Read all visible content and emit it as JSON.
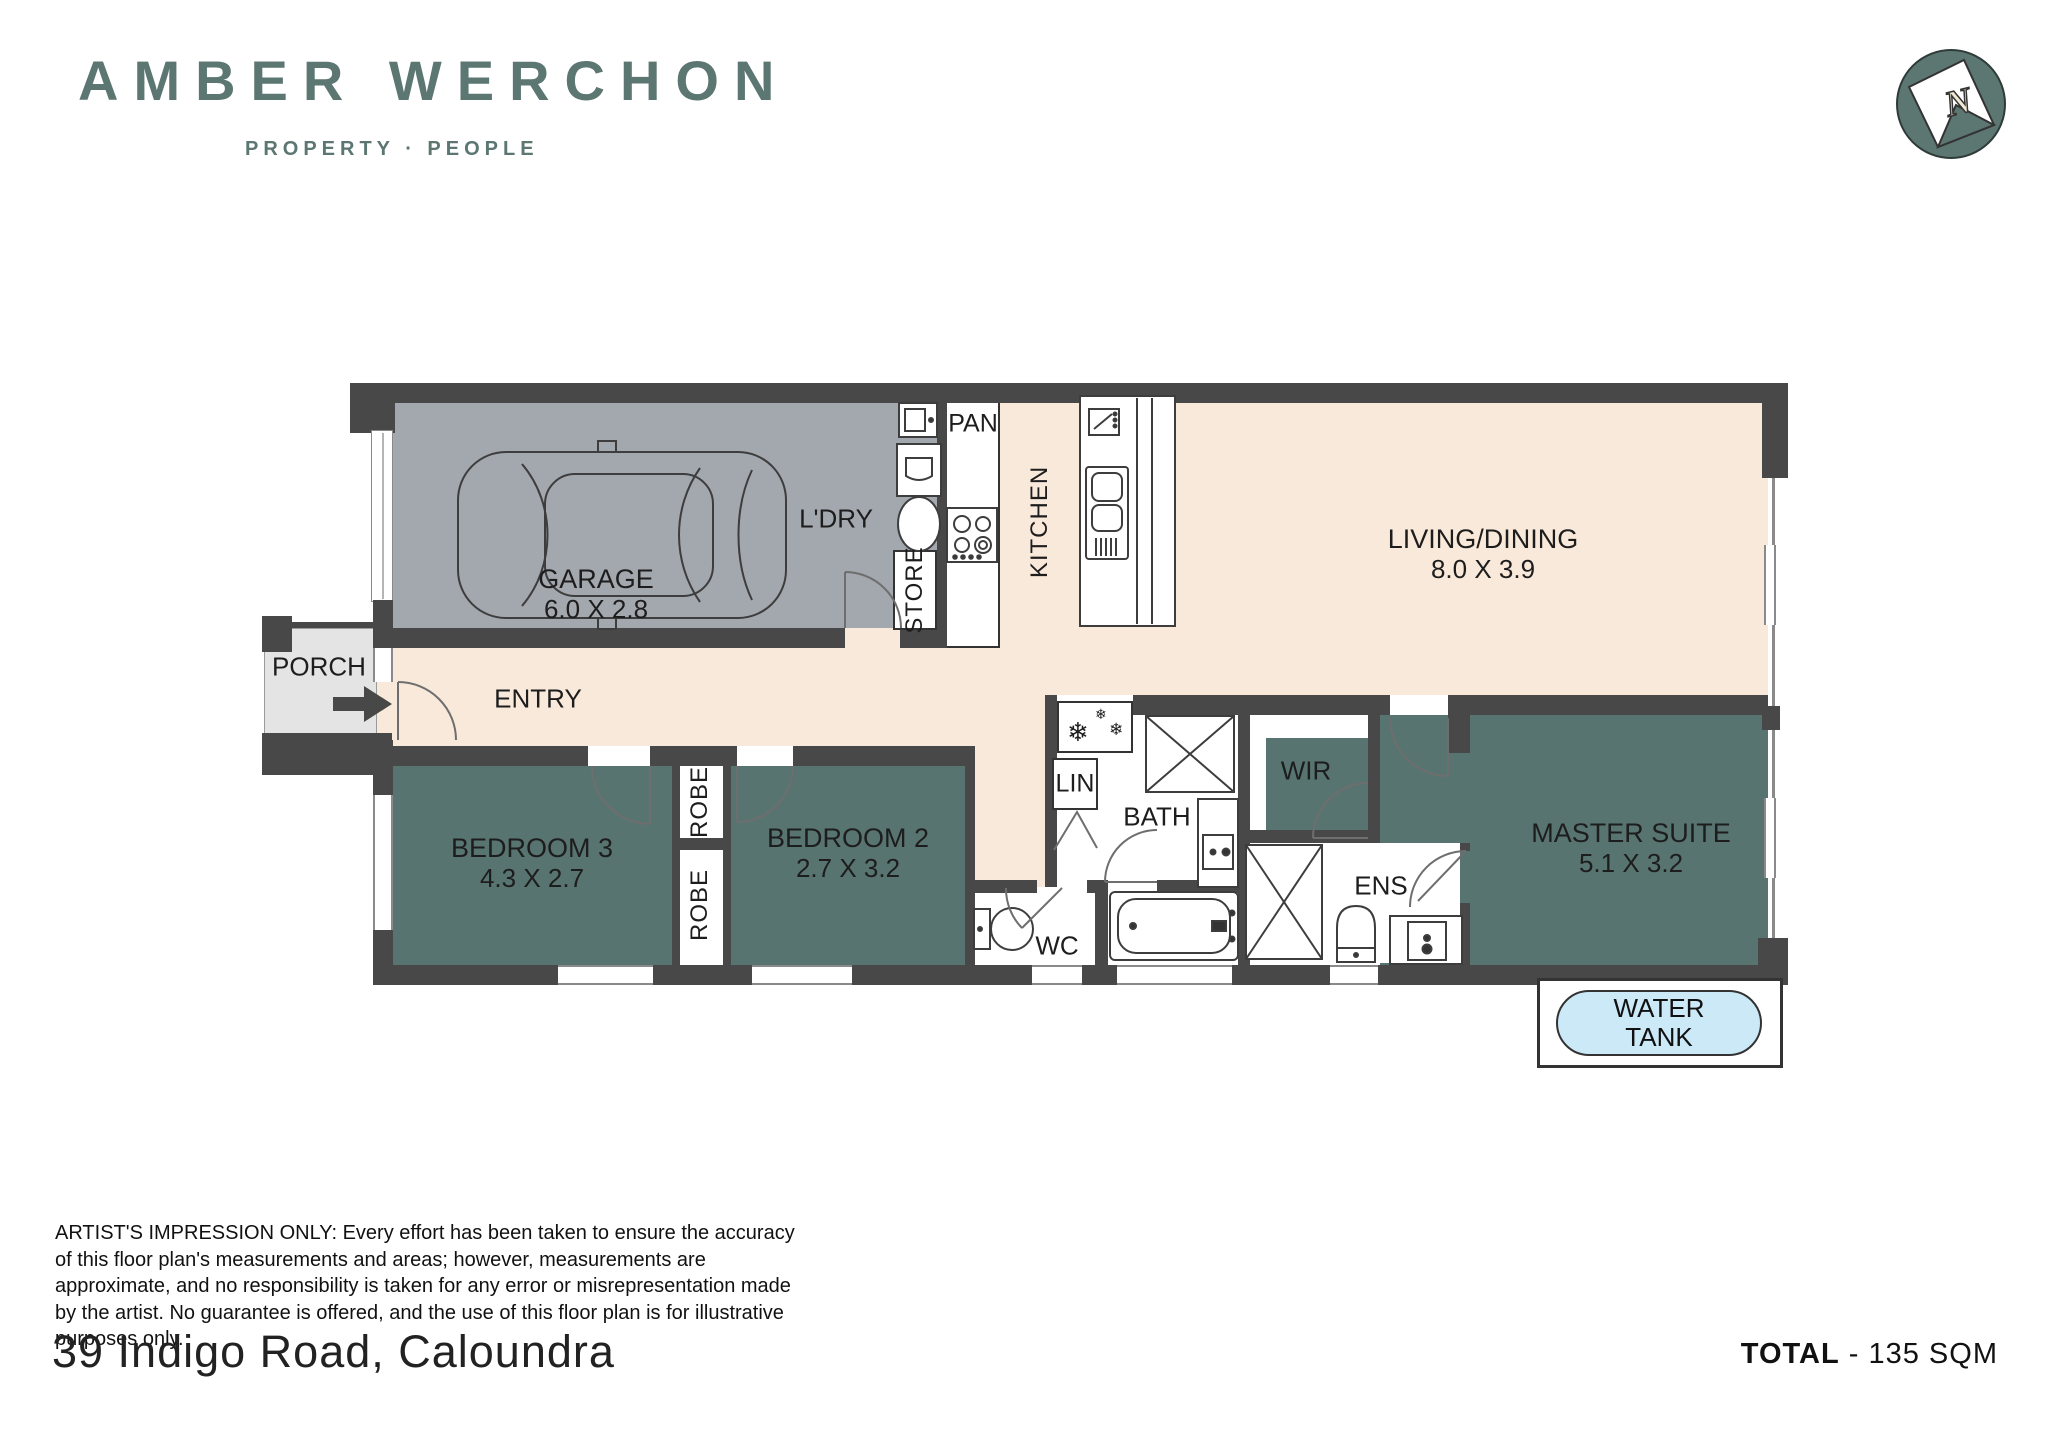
{
  "brand": {
    "title": "AMBER WERCHON",
    "subtitle": "PROPERTY · PEOPLE",
    "color": "#5C7672"
  },
  "compass": {
    "label": "N"
  },
  "floorplan": {
    "rooms": {
      "garage": {
        "name": "GARAGE",
        "dims": "6.0 X 2.8"
      },
      "laundry": {
        "name": "L'DRY"
      },
      "store": {
        "name": "STORE"
      },
      "pantry": {
        "name": "PAN"
      },
      "kitchen": {
        "name": "KITCHEN"
      },
      "living": {
        "name": "LIVING/DINING",
        "dims": "8.0 X 3.9"
      },
      "porch": {
        "name": "PORCH"
      },
      "entry": {
        "name": "ENTRY"
      },
      "bedroom3": {
        "name": "BEDROOM 3",
        "dims": "4.3 X 2.7"
      },
      "robe_upper": {
        "name": "ROBE"
      },
      "robe_lower": {
        "name": "ROBE"
      },
      "bedroom2": {
        "name": "BEDROOM 2",
        "dims": "2.7 X 3.2"
      },
      "linen": {
        "name": "LIN"
      },
      "bath": {
        "name": "BATH"
      },
      "wc": {
        "name": "WC"
      },
      "wir": {
        "name": "WIR"
      },
      "ens": {
        "name": "ENS"
      },
      "master": {
        "name": "MASTER SUITE",
        "dims": "5.1 X 3.2"
      },
      "water_tank": {
        "line1": "WATER",
        "line2": "TANK"
      }
    },
    "icons": {
      "snowflake": "❄"
    },
    "colors": {
      "wall": "#484848",
      "garage_floor": "#A3A7AE",
      "living_floor": "#F9E9DA",
      "bedroom_floor": "#587470",
      "porch_floor": "#E4E4E4",
      "water_tank": "#CBE9F7",
      "brand": "#5C7672"
    }
  },
  "footer": {
    "disclaimer": "ARTIST'S IMPRESSION ONLY: Every effort has been taken to ensure the accuracy of this floor plan's measurements and areas; however, measurements are approximate, and no responsibility is taken for any error or misrepresentation made by the artist. No guarantee is offered, and the use of this floor plan is for illustrative purposes only.",
    "address": "39 Indigo Road, Caloundra",
    "total_label": "TOTAL",
    "total_value": " - 135 SQM"
  }
}
